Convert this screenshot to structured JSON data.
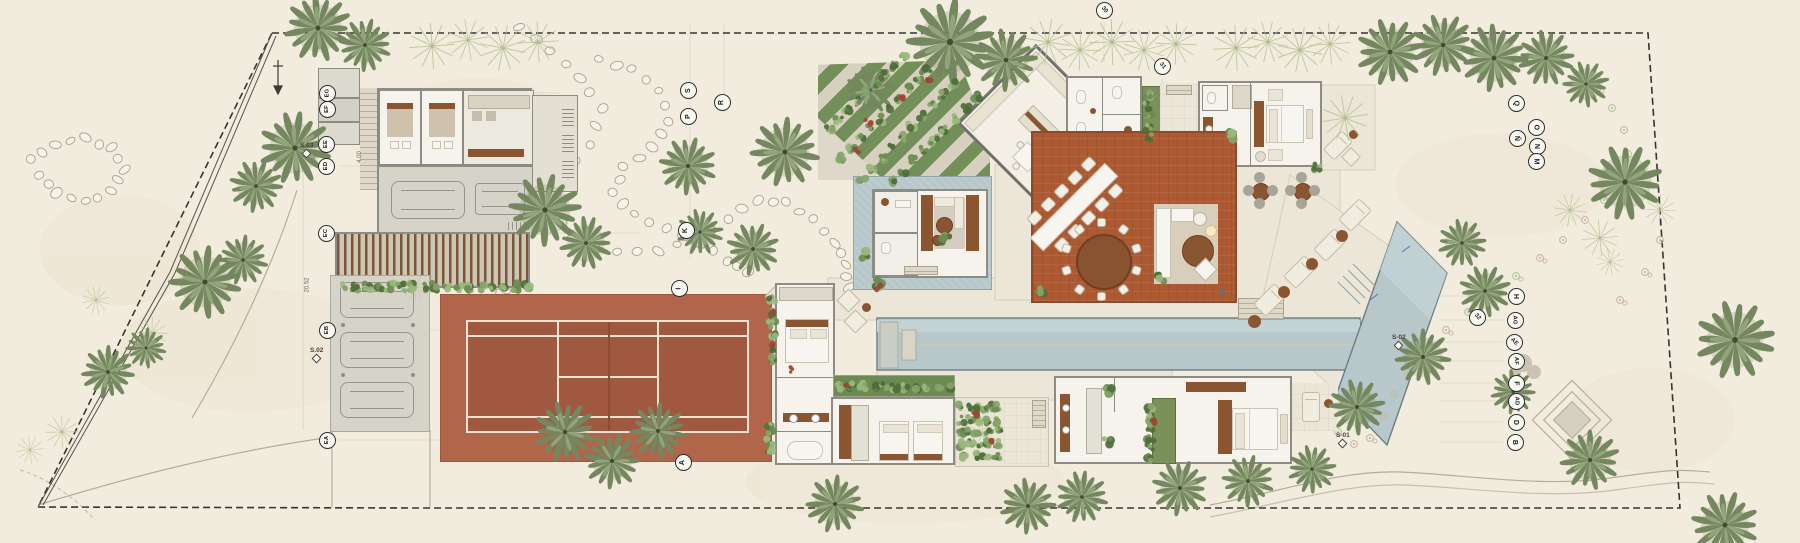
{
  "plan_title": "villa-site-plan",
  "palette": {
    "paper": "#f2ecdf",
    "stone": "#ebe6d7",
    "concrete": "#d6d3c8",
    "terracotta_deck": "#ad5a33",
    "tennis_apron": "#b1654a",
    "tennis_court": "#a15840",
    "water": "#b7c7ca",
    "wood": "#8a5632",
    "palm_dark": "#74875f",
    "palm_light": "#c6cfac",
    "boundary": "#35342e"
  },
  "markers": {
    "west": [
      {
        "label": "EG",
        "x": 327,
        "y": 93
      },
      {
        "label": "EF",
        "x": 327,
        "y": 109
      },
      {
        "label": "EE",
        "x": 326,
        "y": 144
      },
      {
        "label": "ED",
        "x": 326,
        "y": 166
      },
      {
        "label": "EC",
        "x": 326,
        "y": 233
      },
      {
        "label": "EB",
        "x": 327,
        "y": 330
      },
      {
        "label": "EA",
        "x": 327,
        "y": 440
      }
    ],
    "mid": [
      {
        "label": "S",
        "x": 688,
        "y": 90
      },
      {
        "label": "R",
        "x": 722,
        "y": 102
      },
      {
        "label": "P",
        "x": 688,
        "y": 116
      },
      {
        "label": "K",
        "x": 686,
        "y": 230
      },
      {
        "label": "I",
        "x": 679,
        "y": 288
      },
      {
        "label": "A",
        "x": 683,
        "y": 462
      }
    ],
    "east_upper": [
      {
        "label": "Q",
        "x": 1516,
        "y": 103
      },
      {
        "label": "O",
        "x": 1536,
        "y": 127
      },
      {
        "label": "Ñ",
        "x": 1517,
        "y": 138
      },
      {
        "label": "N",
        "x": 1537,
        "y": 146
      },
      {
        "label": "M",
        "x": 1536,
        "y": 161
      }
    ],
    "east_lower": [
      {
        "label": "H",
        "x": 1516,
        "y": 296
      },
      {
        "label": "AG",
        "x": 1515,
        "y": 320
      },
      {
        "label": "AE",
        "x": 1514,
        "y": 342,
        "rot": 45
      },
      {
        "label": "AF",
        "x": 1516,
        "y": 361
      },
      {
        "label": "F",
        "x": 1516,
        "y": 383
      },
      {
        "label": "AD",
        "x": 1516,
        "y": 401
      },
      {
        "label": "D",
        "x": 1516,
        "y": 422
      },
      {
        "label": "B",
        "x": 1515,
        "y": 442
      }
    ],
    "numbers": [
      {
        "label": "30",
        "x": 1104,
        "y": 10,
        "rot": 50
      },
      {
        "label": "31",
        "x": 1162,
        "y": 66,
        "rot": 50
      },
      {
        "label": "32",
        "x": 1477,
        "y": 317,
        "rot": 50
      }
    ]
  },
  "sections": [
    {
      "label": "S.03",
      "x": 300,
      "y": 142
    },
    {
      "label": "S.02",
      "x": 310,
      "y": 347
    },
    {
      "label": "S-01",
      "x": 1336,
      "y": 432
    },
    {
      "label": "S-02",
      "x": 1392,
      "y": 334
    }
  ],
  "dimensions": [
    {
      "label": "20.52",
      "x": 300,
      "y": 282,
      "rot": -90
    },
    {
      "label": "4.00",
      "x": 354,
      "y": 154,
      "rot": -90
    }
  ],
  "site": {
    "boundary": [
      [
        272,
        33
      ],
      [
        1648,
        33
      ],
      [
        1680,
        508
      ],
      [
        412,
        508
      ],
      [
        38,
        507
      ]
    ],
    "fence": [
      [
        272,
        33
      ],
      [
        170,
        272
      ],
      [
        38,
        507
      ]
    ],
    "palms_dark": [
      [
        318,
        28,
        0.7
      ],
      [
        365,
        45,
        0.55
      ],
      [
        295,
        148,
        0.75
      ],
      [
        256,
        186,
        0.55
      ],
      [
        205,
        282,
        0.75
      ],
      [
        243,
        260,
        0.52
      ],
      [
        108,
        372,
        0.55
      ],
      [
        146,
        348,
        0.42
      ],
      [
        545,
        210,
        0.75
      ],
      [
        586,
        243,
        0.55
      ],
      [
        688,
        166,
        0.6
      ],
      [
        700,
        232,
        0.48
      ],
      [
        785,
        152,
        0.72
      ],
      [
        753,
        249,
        0.55
      ],
      [
        950,
        42,
        0.9
      ],
      [
        1006,
        60,
        0.65
      ],
      [
        870,
        90,
        0.5
      ],
      [
        1390,
        52,
        0.7
      ],
      [
        1443,
        45,
        0.65
      ],
      [
        1494,
        58,
        0.7
      ],
      [
        1546,
        58,
        0.58
      ],
      [
        1586,
        84,
        0.48
      ],
      [
        1625,
        182,
        0.78
      ],
      [
        1462,
        243,
        0.5
      ],
      [
        1485,
        291,
        0.54
      ],
      [
        1423,
        357,
        0.58
      ],
      [
        1357,
        407,
        0.58
      ],
      [
        1513,
        392,
        0.46
      ],
      [
        1590,
        460,
        0.62
      ],
      [
        1735,
        340,
        0.82
      ],
      [
        1725,
        525,
        0.7
      ],
      [
        565,
        432,
        0.64
      ],
      [
        612,
        461,
        0.58
      ],
      [
        658,
        431,
        0.58
      ],
      [
        835,
        504,
        0.6
      ],
      [
        1028,
        506,
        0.58
      ],
      [
        1082,
        497,
        0.54
      ],
      [
        1180,
        488,
        0.58
      ],
      [
        1248,
        481,
        0.54
      ],
      [
        1312,
        469,
        0.5
      ]
    ],
    "palms_light": [
      [
        432,
        46,
        0.5
      ],
      [
        468,
        40,
        0.45
      ],
      [
        503,
        48,
        0.5
      ],
      [
        538,
        42,
        0.45
      ],
      [
        1048,
        42,
        0.5
      ],
      [
        1080,
        50,
        0.45
      ],
      [
        1112,
        42,
        0.5
      ],
      [
        1144,
        50,
        0.45
      ],
      [
        1176,
        44,
        0.45
      ],
      [
        1236,
        48,
        0.5
      ],
      [
        1268,
        42,
        0.45
      ],
      [
        1300,
        50,
        0.5
      ],
      [
        1330,
        44,
        0.45
      ],
      [
        415,
        288,
        0.28
      ],
      [
        62,
        432,
        0.36
      ],
      [
        30,
        450,
        0.3
      ],
      [
        152,
        333,
        0.34
      ],
      [
        983,
        433,
        0.3
      ],
      [
        1345,
        118,
        0.5
      ],
      [
        1600,
        238,
        0.4
      ],
      [
        1660,
        210,
        0.34
      ],
      [
        96,
        300,
        0.3
      ],
      [
        1570,
        210,
        0.36
      ],
      [
        1610,
        262,
        0.3
      ]
    ],
    "pebble_chains": [
      [
        [
          520,
          28
        ],
        [
          551,
          50
        ],
        [
          580,
          78
        ],
        [
          601,
          108
        ],
        [
          590,
          145
        ],
        [
          562,
          178
        ],
        [
          552,
          210
        ],
        [
          574,
          238
        ],
        [
          616,
          253
        ],
        [
          658,
          251
        ],
        [
          697,
          239
        ],
        [
          729,
          219
        ],
        [
          757,
          201
        ],
        [
          787,
          202
        ],
        [
          814,
          219
        ],
        [
          835,
          242
        ],
        [
          846,
          266
        ],
        [
          849,
          288
        ]
      ],
      [
        [
          600,
          60
        ],
        [
          631,
          70
        ],
        [
          659,
          92
        ],
        [
          668,
          120
        ],
        [
          652,
          148
        ],
        [
          624,
          167
        ],
        [
          613,
          192
        ],
        [
          633,
          214
        ],
        [
          667,
          229
        ],
        [
          700,
          245
        ],
        [
          728,
          260
        ],
        [
          748,
          273
        ]
      ],
      [
        [
          30,
          160
        ],
        [
          55,
          144
        ],
        [
          85,
          138
        ],
        [
          112,
          148
        ],
        [
          124,
          170
        ],
        [
          112,
          192
        ],
        [
          85,
          201
        ],
        [
          58,
          193
        ],
        [
          40,
          176
        ]
      ],
      [
        [
          468,
          250
        ],
        [
          483,
          263
        ],
        [
          495,
          276
        ],
        [
          504,
          290
        ]
      ]
    ],
    "flower_path": [
      [
        1597,
        88
      ],
      [
        1612,
        108
      ],
      [
        1624,
        130
      ],
      [
        1628,
        154
      ],
      [
        1620,
        178
      ],
      [
        1604,
        200
      ],
      [
        1585,
        220
      ],
      [
        1563,
        240
      ],
      [
        1540,
        258
      ],
      [
        1516,
        276
      ],
      [
        1492,
        294
      ],
      [
        1468,
        312
      ],
      [
        1446,
        330
      ],
      [
        1426,
        350
      ],
      [
        1408,
        372
      ],
      [
        1394,
        394
      ],
      [
        1384,
        416
      ],
      [
        1338,
        432
      ],
      [
        1354,
        444
      ],
      [
        1370,
        438
      ],
      [
        1620,
        300
      ],
      [
        1645,
        272
      ],
      [
        1660,
        240
      ]
    ],
    "shrub_rows": [
      [
        830,
        128,
        903,
        57,
        9
      ],
      [
        842,
        158,
        928,
        70,
        10
      ],
      [
        862,
        180,
        952,
        84,
        10
      ],
      [
        892,
        182,
        976,
        98,
        9
      ],
      [
        842,
        387,
        948,
        387,
        11
      ],
      [
        962,
        408,
        998,
        408,
        5
      ],
      [
        962,
        420,
        998,
        420,
        5
      ],
      [
        962,
        432,
        998,
        432,
        5
      ],
      [
        962,
        444,
        998,
        444,
        5
      ],
      [
        964,
        456,
        996,
        456,
        4
      ],
      [
        1150,
        408,
        1150,
        458,
        6
      ],
      [
        1148,
        95,
        1148,
        138,
        5
      ],
      [
        344,
        287,
        528,
        287,
        17
      ],
      [
        772,
        300,
        772,
        360,
        6
      ],
      [
        770,
        424,
        770,
        452,
        4
      ]
    ],
    "shrub_singles": [
      [
        1160,
        277
      ],
      [
        1040,
        290
      ],
      [
        1318,
        168
      ],
      [
        878,
        284
      ],
      [
        1108,
        390
      ],
      [
        1108,
        442
      ],
      [
        945,
        240
      ],
      [
        1232,
        136
      ],
      [
        865,
        255
      ]
    ],
    "red_shrubs": [
      [
        772,
        312
      ],
      [
        772,
        346
      ],
      [
        845,
        385
      ],
      [
        975,
        415
      ],
      [
        992,
        441
      ],
      [
        1152,
        422
      ],
      [
        878,
        288
      ],
      [
        868,
        122
      ],
      [
        900,
        96
      ],
      [
        856,
        152
      ],
      [
        930,
        80
      ],
      [
        790,
        370
      ]
    ],
    "round_table_chairs": {
      "cx": 1100,
      "cy": 258,
      "r": 37,
      "count": 10
    }
  }
}
